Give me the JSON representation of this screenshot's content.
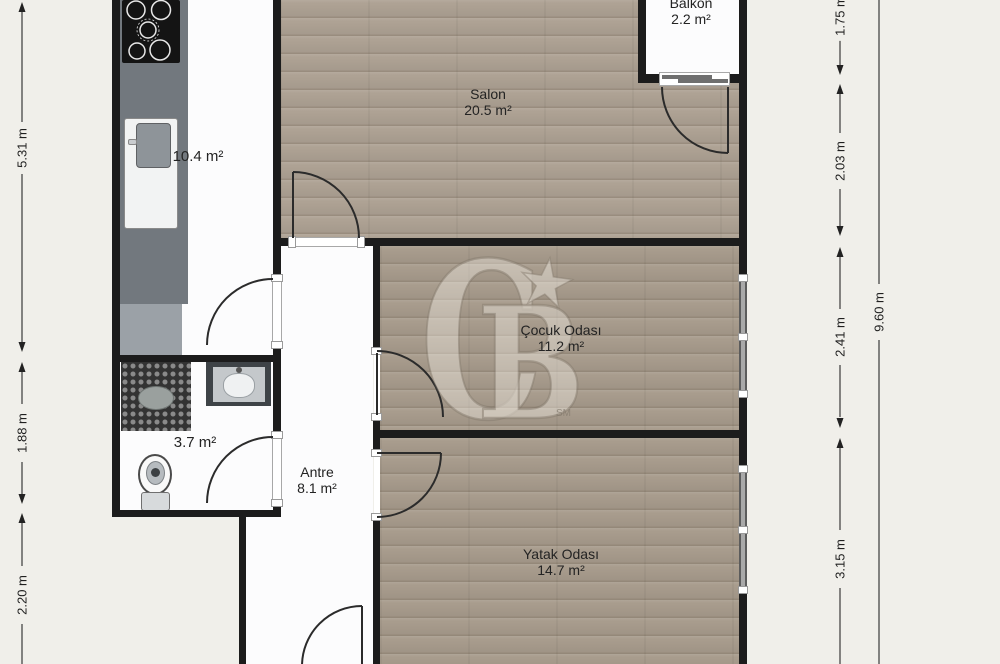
{
  "rooms": {
    "salon": {
      "name": "Salon",
      "area": "20.5 m²"
    },
    "balkon": {
      "name": "Balkon",
      "area": "2.2 m²"
    },
    "cocuk": {
      "name": "Çocuk Odası",
      "area": "11.2 m²"
    },
    "yatak": {
      "name": "Yatak Odası",
      "area": "14.7 m²"
    },
    "antre": {
      "name": "Antre",
      "area": "8.1 m²"
    },
    "kitchen": {
      "area": "10.4 m²"
    },
    "bathroom": {
      "area": "3.7 m²"
    }
  },
  "dims": {
    "left_kitchen": "5.31 m",
    "left_bath": "1.88 m",
    "left_lower": "2.20 m",
    "right_balcony": "1.75 m",
    "right_salon": "2.03 m",
    "right_cocuk": "2.41 m",
    "right_yatak": "3.15 m",
    "right_total": "9.60 m"
  },
  "watermark": {
    "c": "C",
    "b": "B",
    "star": "★",
    "sm": "SM"
  },
  "colors": {
    "background": "#f0efea",
    "wall": "#1c1c1c",
    "wood_light": "#aea294",
    "wood_dark": "#a89c8d",
    "counter": "#72787e"
  }
}
